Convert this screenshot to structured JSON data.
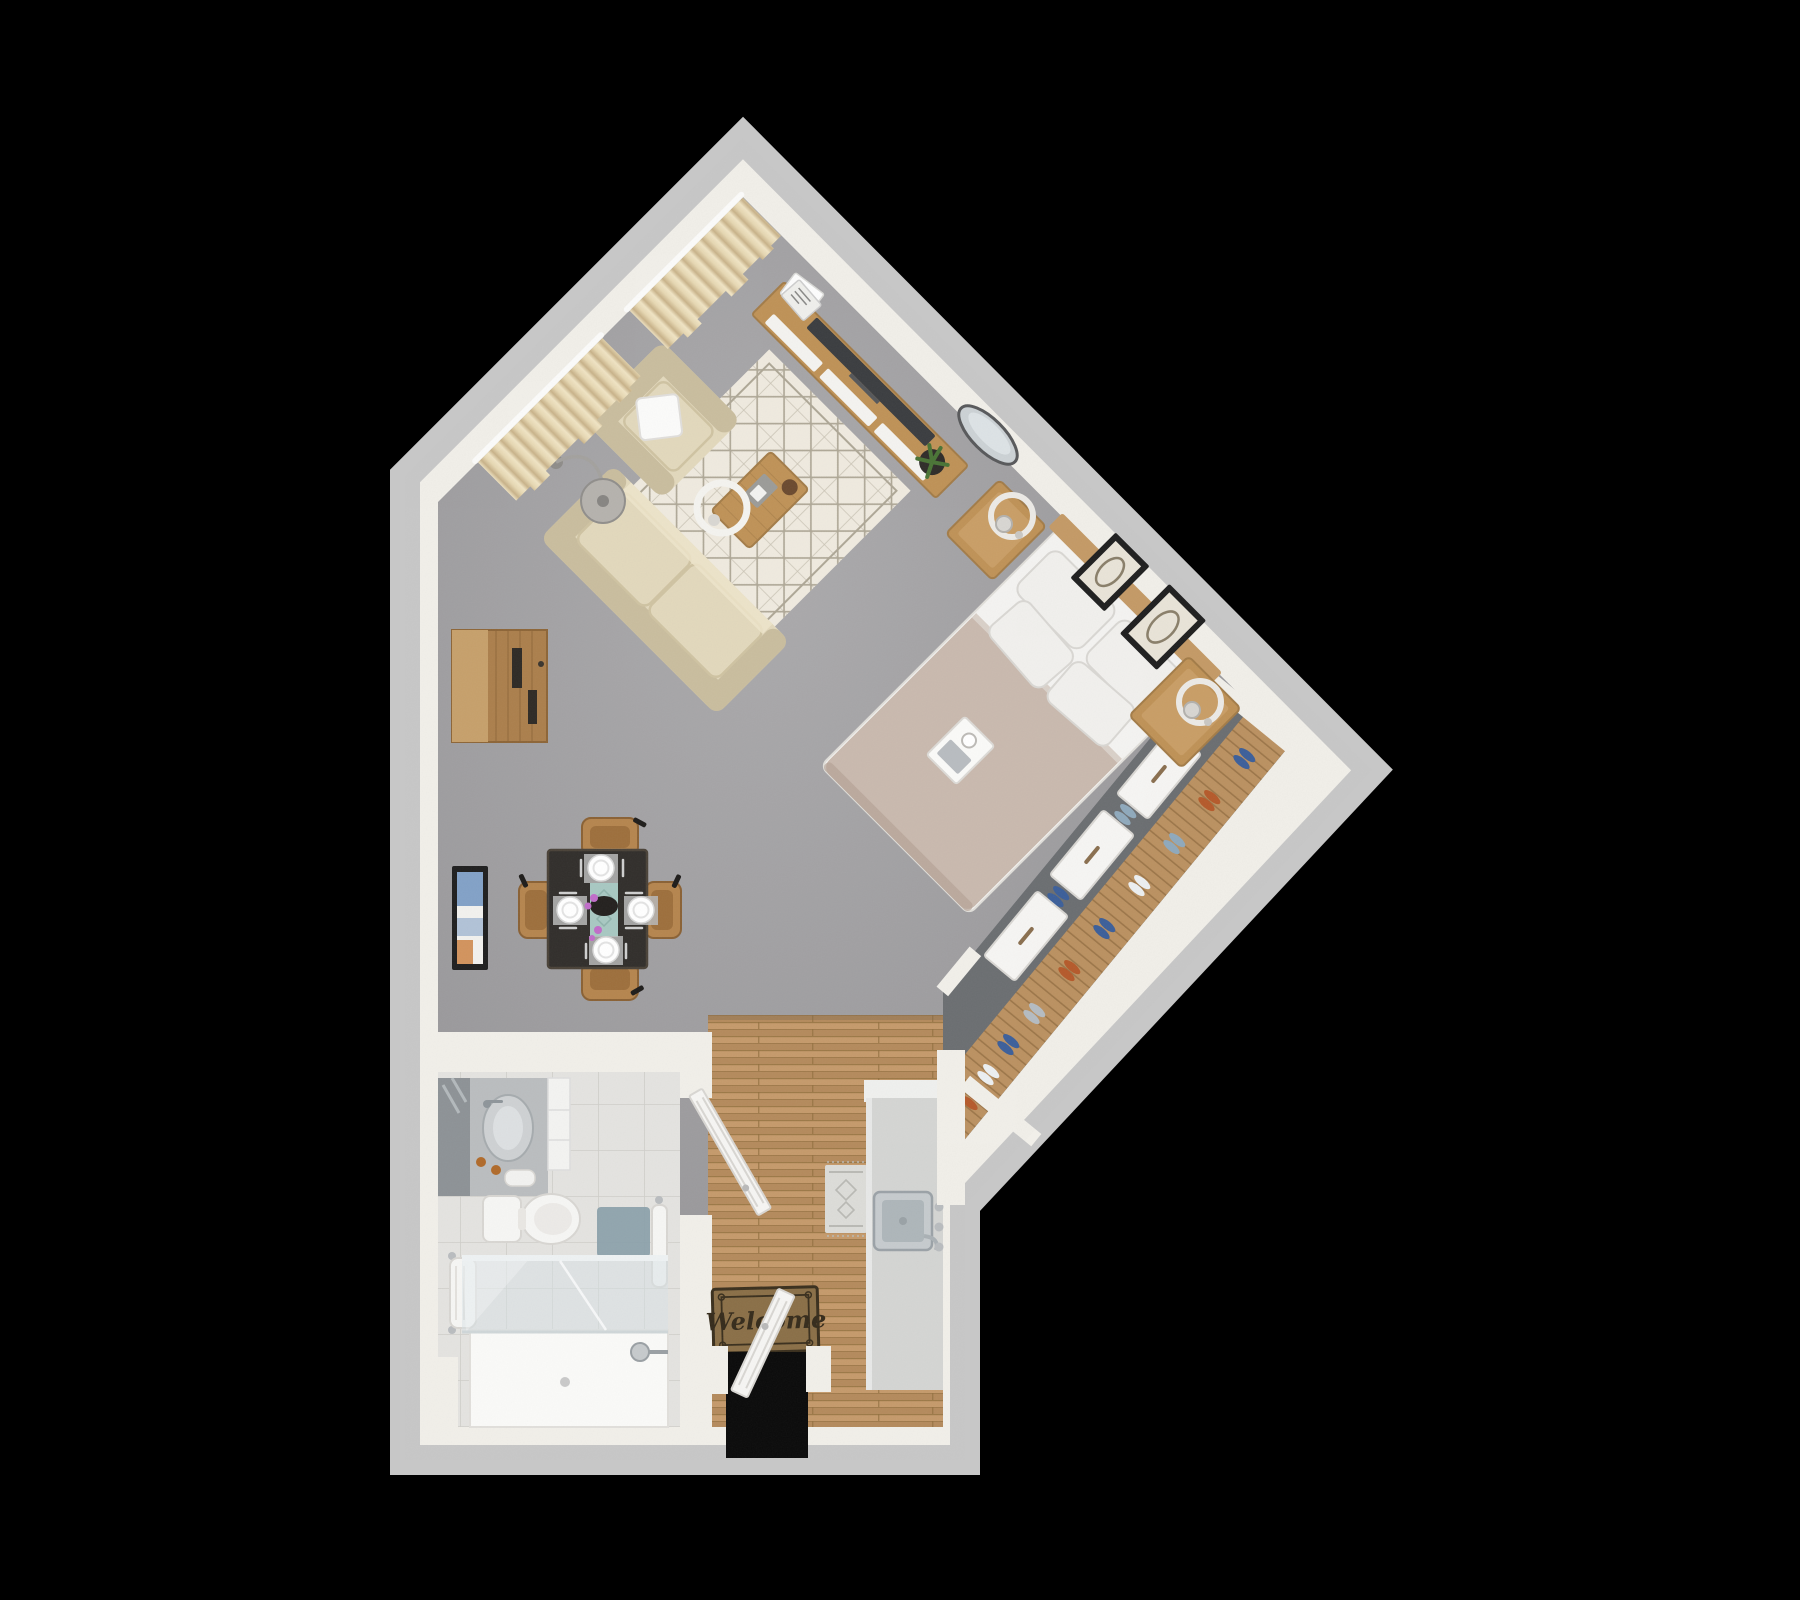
{
  "mat": {
    "text": "Welcome"
  },
  "palette": {
    "bg": "#000000",
    "wall_face": "#f1efe9",
    "wall_rim": "#c7c7c7",
    "wall_shadow": "#dbd8d2",
    "carpet_a": "#abaaac",
    "carpet_b": "#8f8e91",
    "wood_a": "#c59a6b",
    "wood_b": "#b48a5c",
    "wood_seam": "#92703f",
    "tile": "#e4e3e0",
    "tile_line": "#cfcec9",
    "closet_floor": "#6b6e71",
    "slat": "#bb9161",
    "slat_seam": "#9c7649",
    "sofa": "#e2d8bc",
    "sofa_shade": "#c9bd9e",
    "rug": "#efeadf",
    "rug_line": "#aea796",
    "wood_furn": "#bf9257",
    "wood_furn_dark": "#a37c48",
    "tv": "#3b3d40",
    "duvet": "#c9b9ae",
    "linen": "#f4f3f1",
    "pillow": "#f1f0ed",
    "pillow_line": "#d9d7d3",
    "curtain": "#e6d7b2",
    "curtain_fold": "#c8b289",
    "table_top": "#312e2b",
    "runner_teal": "#a8c8c2",
    "chair_wood": "#b5854e",
    "counter": "#d4d5d3",
    "counter_cap": "#eff0ee",
    "steel": "#c6cbce",
    "steel_dark": "#9ba2a7",
    "basin": "#aeb6ba",
    "mat_brown": "#8a6f47",
    "mat_border": "#3a2f1d",
    "mat_text": "#352b1b",
    "door_leaf": "#f6f5f3",
    "door_seam": "#d8d6d2",
    "glass": "#d7e2e6",
    "tray_white": "#fafaf8",
    "vanity_top": "#babdbf",
    "vanity_dark": "#8d9296",
    "porcelain": "#f6f6f4",
    "porcelain_line": "#d8d6d2",
    "bathmat": "#8aa0a9",
    "navy": "#3c5f9a",
    "rust": "#b55a2b",
    "steel_blue": "#8fa9bc",
    "shoe_white": "#eceff1",
    "shoe_gray": "#b5bcc2",
    "plant": "#4a7436",
    "pot": "#2f2c29",
    "ring": "#eceae6",
    "chrome": "#b9bcbf",
    "shade": "#b5b2ad",
    "frame_dark": "#1f1f1f",
    "art_cream": "#e9e4d8",
    "art_blue": "#6f93c0",
    "art_orange": "#cd8243",
    "orchid": "#c06cc9",
    "runner_rug": "#dcdcd8",
    "runner_motif": "#b9b9b4",
    "void": "#0a0a0a"
  }
}
